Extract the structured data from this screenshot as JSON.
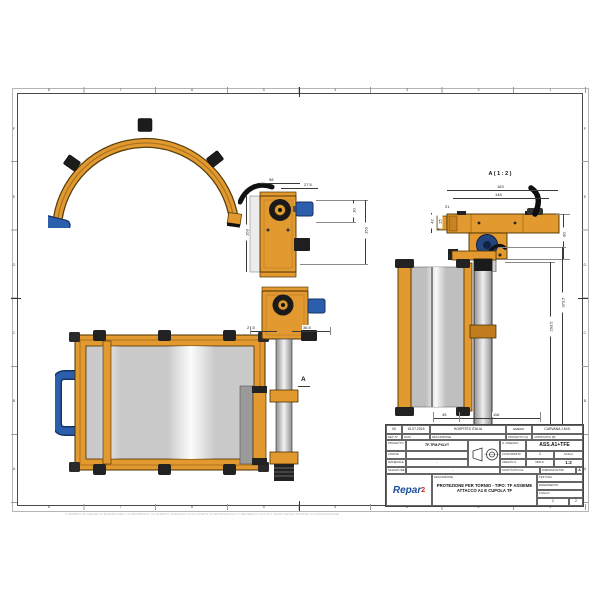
{
  "sheet": {
    "frame_columns": [
      "8",
      "7",
      "6",
      "5",
      "4",
      "3",
      "2",
      "1"
    ],
    "frame_rows": [
      "F",
      "E",
      "D",
      "C",
      "B",
      "A"
    ]
  },
  "views": {
    "side_mount": {
      "dim_top": "98",
      "dim_offset": "27.5",
      "dim_left": "163",
      "dim_right_upper": "30",
      "dim_right_lower": "150"
    },
    "detail_a": {
      "title": "A ( 1 : 2 )",
      "dim_width_outer": "163",
      "dim_width_inner": "148",
      "dim_tab": "21",
      "dim_left_outer": "42",
      "dim_left_inner": "25",
      "dim_height": "80"
    },
    "column_front": {
      "dim_left": "27.5",
      "dim_right": "36.5",
      "detail_marker": "A"
    },
    "assembly_side": {
      "dim_height_outer": "373.5",
      "dim_height_inner": "293.5",
      "dim_bottom_left": "45",
      "dim_bottom_right": "116"
    }
  },
  "title_block": {
    "rev": "00",
    "date": "15.07.2015",
    "description": "HOSPITEX ITALIA",
    "issued_label": "EMESS.",
    "issued_by": "CARVANA J.M.B.",
    "rev_label": "REV. N°",
    "date_label": "DATA",
    "description_label": "DESCRIZIONE",
    "project_label": "PROGETTO (A)",
    "approved_label": "APPROVATO (B)",
    "project_field_label": "PROGETTO",
    "project_value": "TF-TFM-PXLVT",
    "drawing_no_label": "N. DISEGNO",
    "drawing_no": "ASS.A1+TFE",
    "code_label": "CODICE",
    "code_value": "",
    "conformity_label": "CONFORMITA'",
    "conformity_value": "1",
    "scale_label": "SCALA",
    "scale_value": "1:2",
    "material_label": "MATERIALE",
    "material_value": "-",
    "created_label": "CREATO IL",
    "created_value": "MIS.S.",
    "weld_label": "SALDATURE",
    "weld_value": "-",
    "replaced_label": "SOSTITUITO DA",
    "dxf_label": "DIMENSION DXF",
    "sheet_size": "A",
    "logo_text": "Repar",
    "logo_sup": "2",
    "desc_caption": "DESCRIZIONE",
    "title_line1": "PROTEZIONE PER TORNIO - TIPO: TF ASSIEME",
    "title_line2": "ATTACCO A1 E CUPOLA TF",
    "finish_label": "FINITURA",
    "reference_label": "RIFERIMENTO",
    "sheet_label": "FOGLIO",
    "sheet_no": "1",
    "sheet_of": "2"
  },
  "colors": {
    "orange": "#E2992F",
    "orange_dark": "#6B4A0A",
    "blue": "#2B5FAE",
    "blue_dark": "#15335F",
    "panel_gray": "#C9C9C9",
    "line": "#3A3A3A"
  },
  "footer": {
    "disclaimer": "A TERMINI DI LEGGE CI RISERVIAMO LA PROPRIETA' DI QUESTO DISEGNO CON DIVIETO DI RIPRODURLO O RENDERLO NOTO A TERZI SENZA NOSTRA AUTORIZZAZIONE"
  }
}
